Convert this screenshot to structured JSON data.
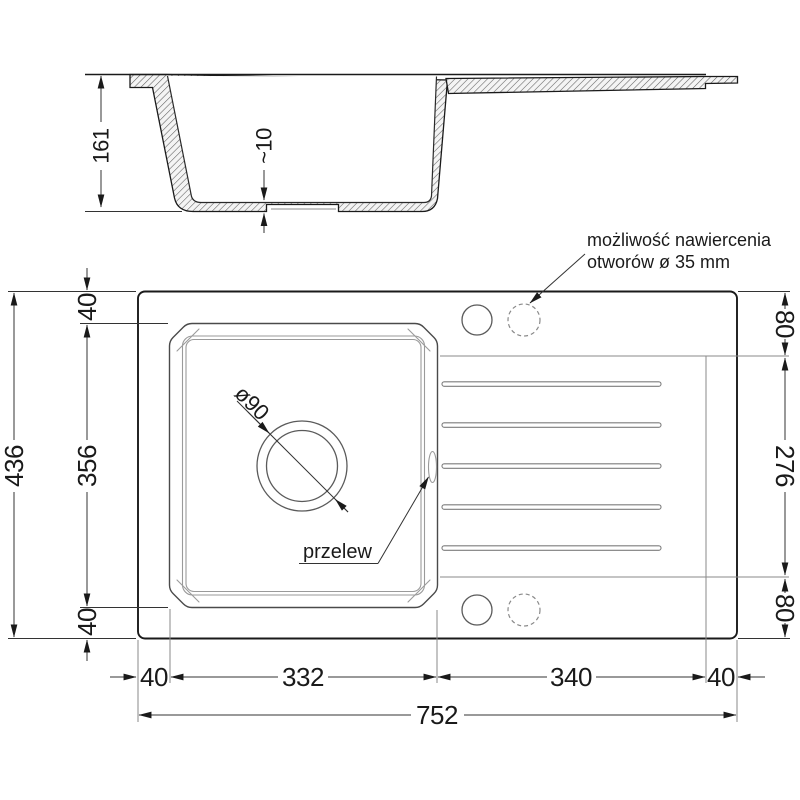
{
  "drawing": {
    "colors": {
      "line": "#1a1a1a",
      "secondary": "#8a8a8a"
    },
    "section_view": {
      "depth_label": "161",
      "recess_label": "~10"
    },
    "top_view": {
      "drill_note": {
        "line1": "możliwość nawiercenia",
        "line2": "otworów ø 35 mm"
      },
      "overflow_label": "przelew",
      "drain_label": "ø90",
      "left_dims": {
        "top_margin": "40",
        "bowl_length": "356",
        "bottom_margin": "40",
        "total_height": "436"
      },
      "right_dims": {
        "top": "80",
        "drainer_length": "276",
        "bottom": "80"
      },
      "bottom_dims": {
        "left_margin": "40",
        "bowl_width": "332",
        "drainer_width": "340",
        "right_margin": "40",
        "total_width": "752"
      }
    }
  }
}
